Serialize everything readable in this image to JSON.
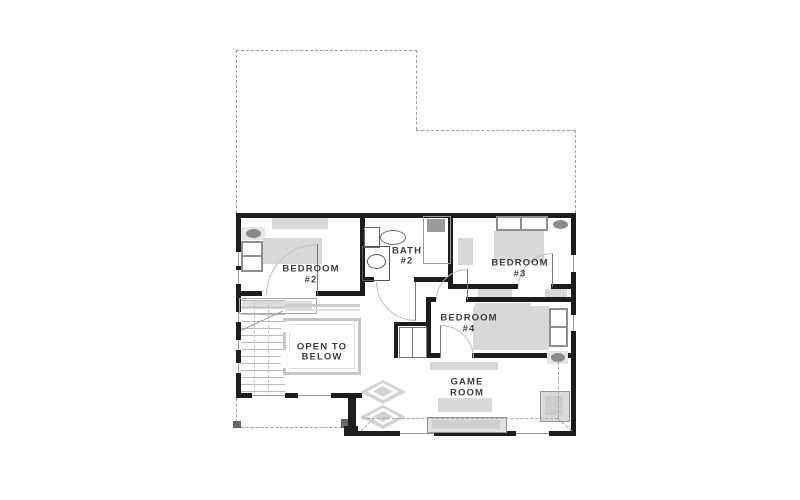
{
  "rooms": {
    "bedroom2": {
      "line1": "BEDROOM",
      "line2": "#2"
    },
    "bath2": {
      "line1": "BATH",
      "line2": "#2"
    },
    "bedroom3": {
      "line1": "BEDROOM",
      "line2": "#3"
    },
    "bedroom4": {
      "line1": "BEDROOM",
      "line2": "#4"
    },
    "open_to_below": {
      "line1": "OPEN TO",
      "line2": "BELOW"
    },
    "game_room": {
      "line1": "GAME",
      "line2": "ROOM"
    }
  },
  "colors": {
    "background": "#ffffff",
    "wall": "#1d1d1d",
    "furniture_fill": "#d8d8d8",
    "furniture_accent": "#8f8f8f",
    "dashed_outline": "#9b9b9b",
    "label_text": "#3d3d3d"
  }
}
